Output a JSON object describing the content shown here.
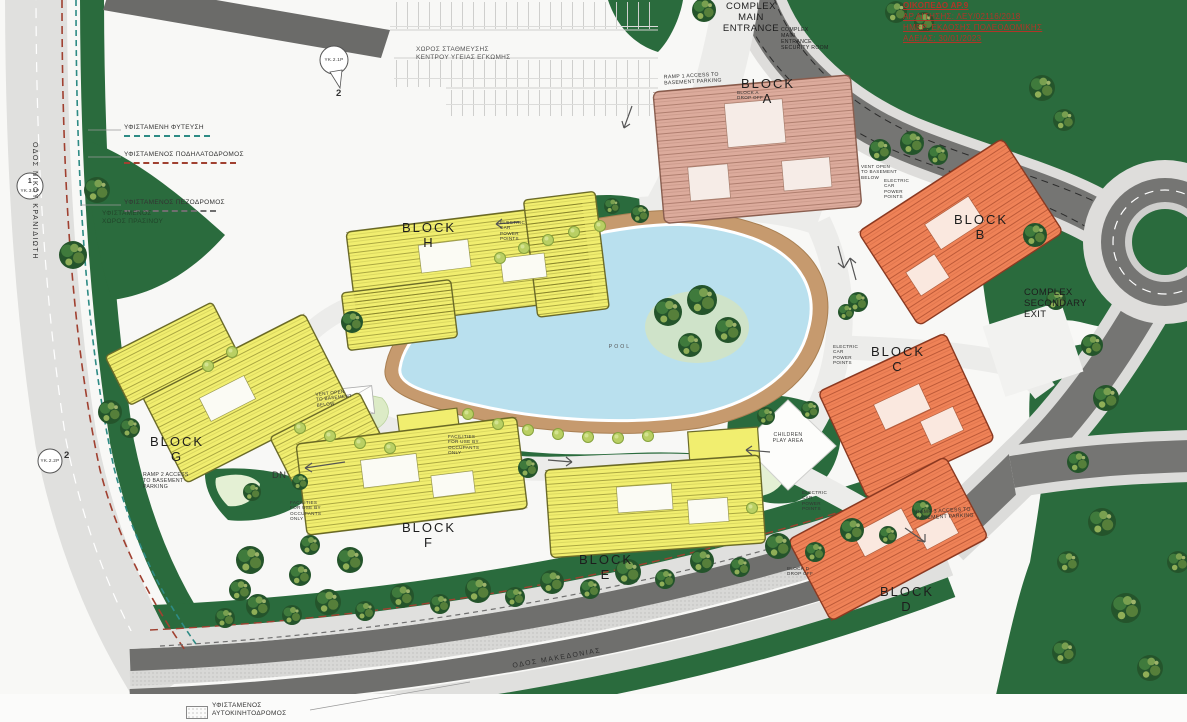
{
  "title_block": {
    "lines": [
      "ΟΙΚΟΠΕΔΟ ΑΡ.9",
      "ΑΡ.ΑΙΤΗΣΗΣ: ΛΕΥ/02116/2018",
      "ΗΜΕΡ. ΕΚΔΟΣΗΣ ΠΟΛΕΟΔΟΜΙΚΗΣ",
      "ΑΔΕΙΑΣ: 30/01/2023"
    ]
  },
  "legend": {
    "items": [
      {
        "label": "ΥΦΙΣΤΑΜΕΝΗ ΦΥΤΕΥΣΗ",
        "color": "#2e8b85"
      },
      {
        "label": "ΥΦΙΣΤΑΜΕΝΟΣ ΠΟΔΗΛΑΤΟΔΡΟΜΟΣ",
        "color": "#a04030"
      },
      {
        "label": "ΥΦΙΣΤΑΜΕΝΟΣ ΠΕΖΟΔΡΟΜΟΣ",
        "color": "#6f6f6f"
      }
    ],
    "bottom_item": "ΥΦΙΣΤΑΜΕΝΟΣ\nΑΥΤΟΚΙΝΗΤΟΔΡΟΜΟΣ"
  },
  "roads": {
    "left_name": "ΟΔΟΣ ΝΙΚΟΥ ΚΡΑΝΙΔΙΩΤΗ",
    "bottom_name": "ΟΔΟΣ ΜΑΚΕΔΟΝΙΑΣ"
  },
  "areas": {
    "health_parking": "ΧΩΡΟΣ ΣΤΑΘΜΕΥΣΗΣ\nΚΕΝΤΡΟΥ ΥΓΕΙΑΣ ΕΓΚΩΜΗΣ",
    "green_space": "ΥΦΙΣΤΑΜΕΝΟΣ\nΧΩΡΟΣ ΠΡΑΣΙΝΟΥ",
    "pool": "POOL",
    "play": "CHILDREN\nPLAY AREA",
    "dn": "DN"
  },
  "entrances": {
    "main": "COMPLEX\nMAIN\nENTRANCE",
    "security": "COMPLEX\nMAIN\nENTRANCE\nSECURITY ROOM",
    "secondary": "COMPLEX\nSECONDARY\nEXIT"
  },
  "blocks": {
    "word": "BLOCK",
    "letters": [
      "A",
      "B",
      "C",
      "D",
      "E",
      "F",
      "G",
      "H"
    ]
  },
  "ramps": {
    "r1": "RAMP 1 ACCESS TO\nBASEMENT PARKING",
    "r2": "RAMP 2 ACCESS\nTO BASEMENT\nPARKING",
    "r3": "RAMP 3 ACCESS TO\nBASEMENT PARKING"
  },
  "notes": {
    "vent": "VENT OPEN\nTO BASEMENT\nBELOW",
    "facilities": "FACILITIES\nFOR USE BY\nOCCUPANTS\nONLY",
    "electric": "ELECTRIC\nCAR\nPOWER\nPOINTS",
    "dropoff_a": "BLOCK A\nDROP OFF",
    "dropoff_d": "BLOCK D\nDROP OFF"
  },
  "markers": [
    {
      "num": "1",
      "code": "ΥΚ.3.1Ρ"
    },
    {
      "num": "2",
      "code": "ΥΚ.2.1Ρ"
    },
    {
      "num": "2",
      "code": "ΥΚ.2.2Ρ"
    }
  ],
  "colors": {
    "green": "#2a6b3d",
    "road": "#6f6f6d",
    "sidewalk": "#e0e0de",
    "pool": "#b9e0ee",
    "deck": "#c69a6e",
    "yellow_block": "#f1ee6f",
    "orange_block": "#ef8257",
    "tan_block": "#dcab9c",
    "annotation_red": "#b03528"
  }
}
